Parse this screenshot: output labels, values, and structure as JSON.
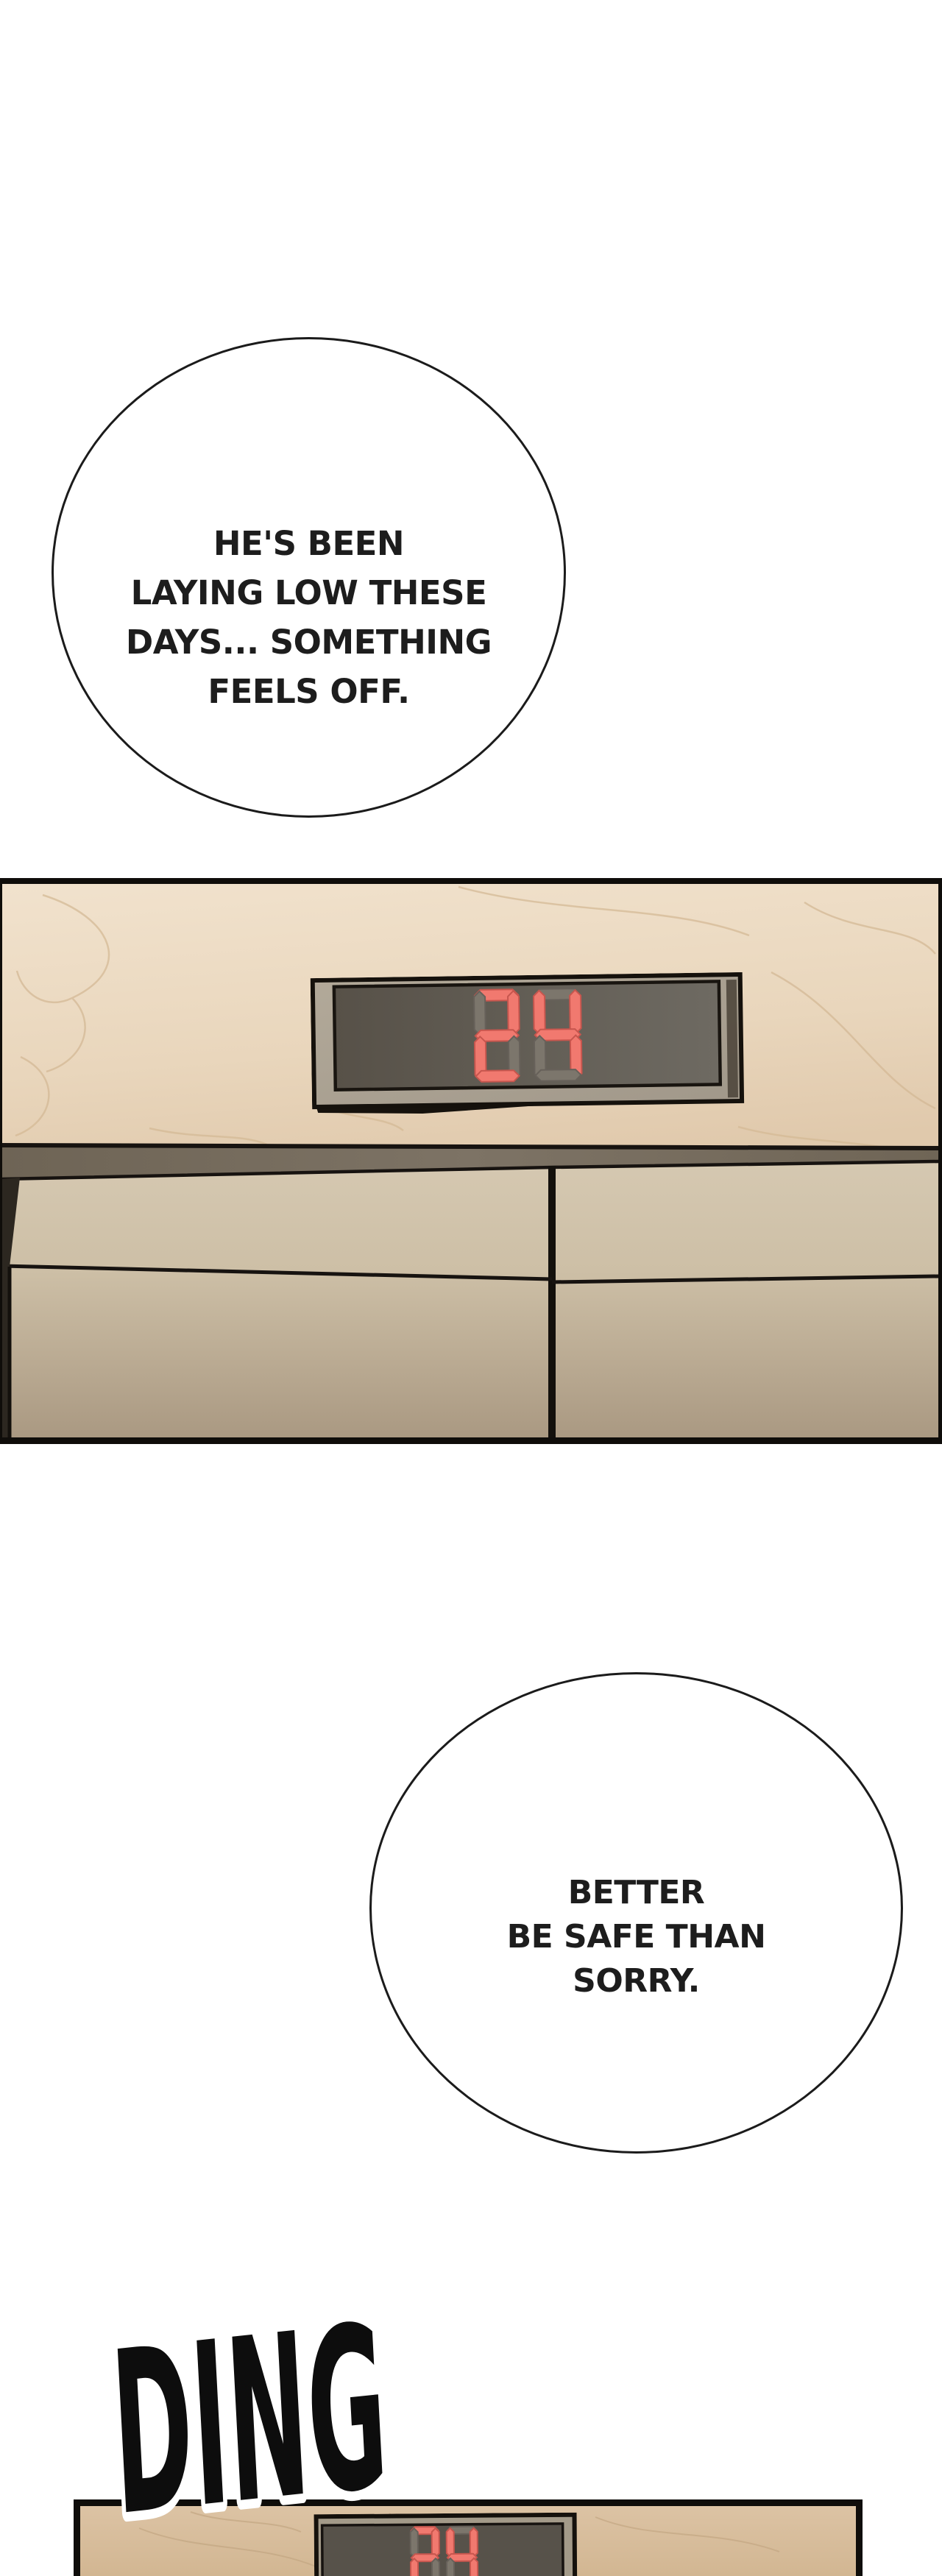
{
  "page": {
    "background": "#ffffff",
    "kind": "webtoon-episode-strip"
  },
  "bubbles": [
    {
      "id": "bubble-1",
      "lines": [
        "HE'S BEEN",
        "LAYING LOW THESE",
        "DAYS... SOMETHING",
        "FEELS OFF."
      ]
    },
    {
      "id": "bubble-2",
      "lines": [
        "BETTER",
        "BE SAFE THAN",
        "SORRY."
      ]
    }
  ],
  "sfx": {
    "text": "DING"
  },
  "panels": [
    {
      "name": "elevator-hall-closeup",
      "display": {
        "value": "24",
        "digits": [
          "2",
          "4"
        ],
        "lit_color": "#f1796f",
        "lit_edge": "#c7564e",
        "unlit_color": "#7c766c",
        "unlit_edge": "#67615a",
        "screen_color": "#5b564d",
        "frame_color": "#a9a090"
      }
    },
    {
      "name": "elevator-hall-far",
      "display": {
        "value": "24",
        "digits": [
          "2",
          "4"
        ],
        "lit_color": "#f1796f",
        "lit_edge": "#c7564e",
        "unlit_color": "#7c766c",
        "unlit_edge": "#67615a",
        "screen_color": "#57524a",
        "frame_color": "#a39a89"
      }
    }
  ],
  "colors": {
    "panel_border": "#0f0d0a",
    "wall_marble_light": "#f0e1cb",
    "wall_marble_dark": "#e0c9ac",
    "marble_vein": "#d4b996",
    "door_header_beam": "#756b5c",
    "door_upper": "#d5c8b1",
    "door_lower": "#ab9a83",
    "bubble_outline": "#1b1b1b",
    "sfx_fill": "#0d0d0d",
    "sfx_outline": "#ffffff"
  }
}
